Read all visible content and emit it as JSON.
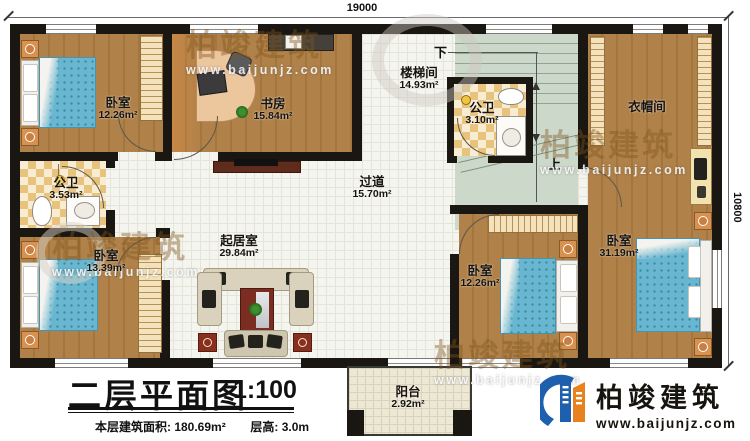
{
  "plan": {
    "dimensions": {
      "top": "19000",
      "right": "10800"
    },
    "rooms": [
      {
        "name": "卧室",
        "area": "12.26m²"
      },
      {
        "name": "书房",
        "area": "15.84m²"
      },
      {
        "name": "楼梯间",
        "area": "14.93m²"
      },
      {
        "name": "公卫",
        "area": "3.10m²"
      },
      {
        "name": "衣帽间",
        "area": ""
      },
      {
        "name": "公卫",
        "area": "3.53m²"
      },
      {
        "name": "过道",
        "area": "15.70m²"
      },
      {
        "name": "卧室",
        "area": "13.39m²"
      },
      {
        "name": "起居室",
        "area": "29.84m²"
      },
      {
        "name": "卧室",
        "area": "12.26m²"
      },
      {
        "name": "卧室",
        "area": "31.19m²"
      },
      {
        "name": "阳台",
        "area": "2.92m²"
      }
    ],
    "stairs": {
      "down": "下",
      "up": "上"
    }
  },
  "title_block": {
    "title": "二层平面图",
    "scale": "1:100",
    "area_label": "本层建筑面积: 180.69m²",
    "floor_height_label": "层高: 3.0m"
  },
  "logo": {
    "name": "柏竣建筑",
    "website": "www.baijunjz.com"
  },
  "watermark": {
    "brand": "柏竣建筑",
    "website": "www.baijunjz.com"
  },
  "colors": {
    "wall": "#1a1611",
    "wood": "#ab7d43",
    "bed_blue": "#68b6d0",
    "checker_tan": "#e8c37d",
    "stair_green": "#ccd8ca",
    "logo_blue": "#1e5fae",
    "logo_orange": "#e8821e"
  }
}
